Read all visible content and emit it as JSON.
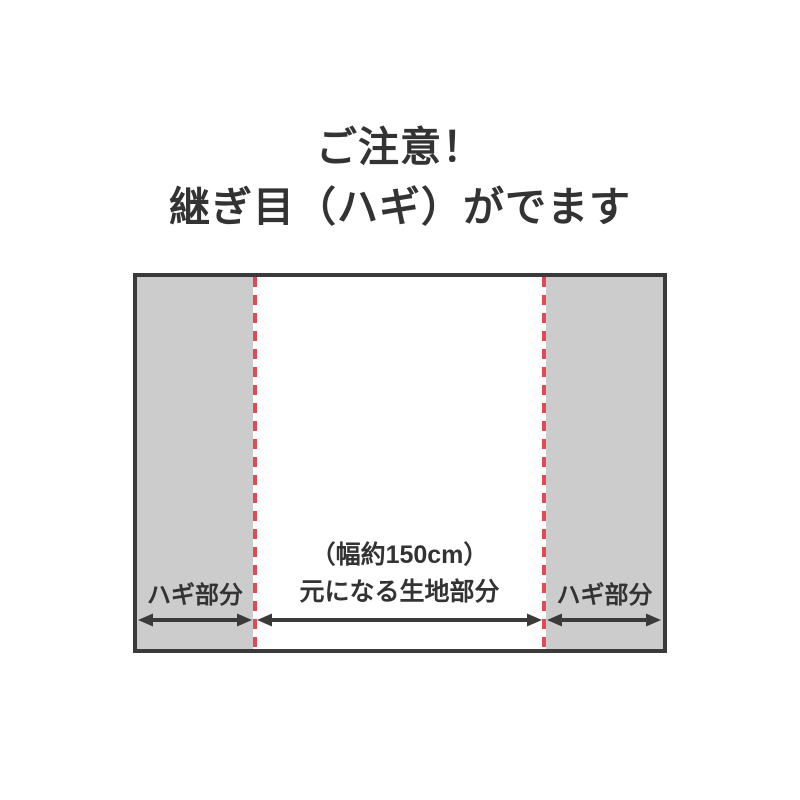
{
  "title": {
    "line1": "ご注意！",
    "line2": "継ぎ目（ハギ）がでます"
  },
  "diagram": {
    "left_panel_label": "ハギ部分",
    "right_panel_label": "ハギ部分",
    "center_label_line1": "（幅約150cm）",
    "center_label_line2": "元になる生地部分"
  },
  "icons": {
    "left_arrow": "double-headed-width-arrow",
    "center_arrow": "double-headed-width-arrow",
    "right_arrow": "double-headed-width-arrow"
  },
  "colors": {
    "text_dark": "#333333",
    "border_dark": "#3a3a3a",
    "panel_gray": "#cccccc",
    "seam_red": "#e04a50",
    "background": "#ffffff"
  }
}
